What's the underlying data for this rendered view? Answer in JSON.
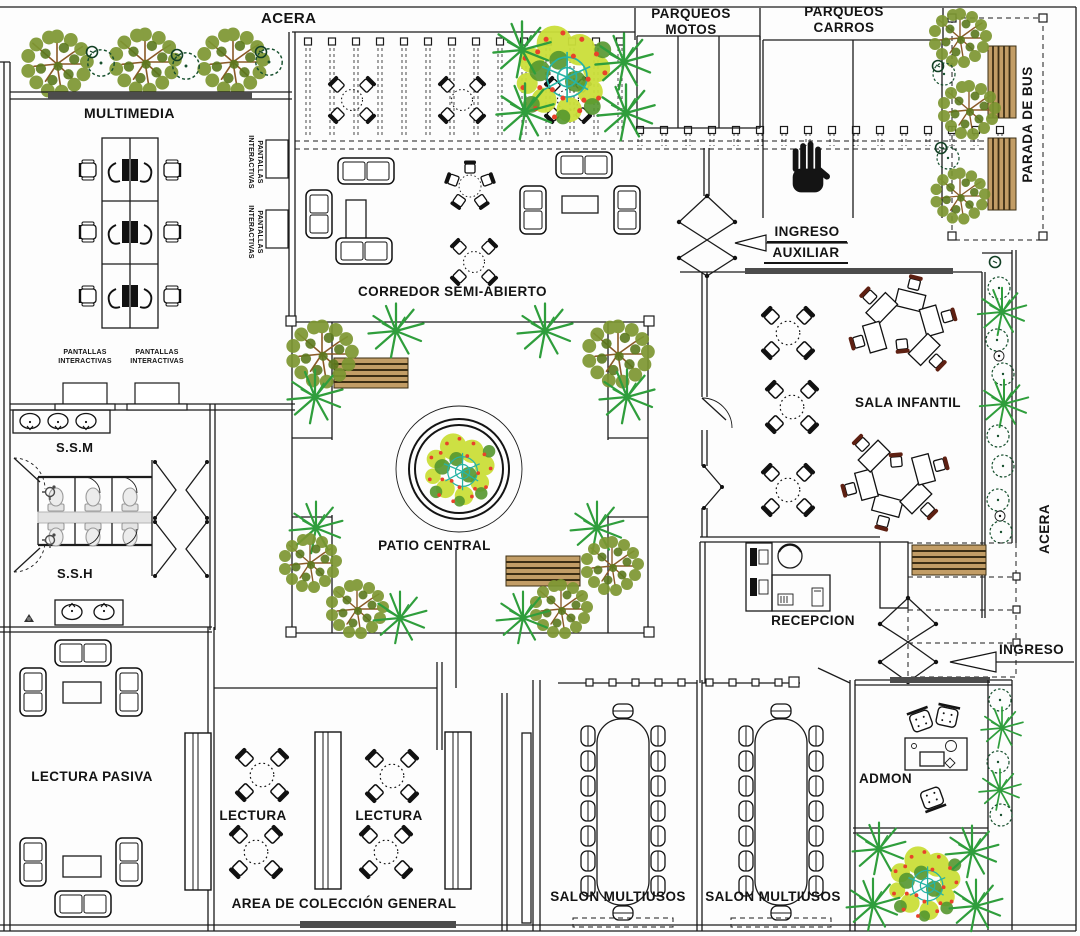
{
  "labels": {
    "acera_top": "ACERA",
    "parqueos_motos_1": "PARQUEOS",
    "parqueos_motos_2": "MOTOS",
    "parqueos_carros_1": "PARQUEOS",
    "parqueos_carros_2": "CARROS",
    "parada_bus": "PARADA DE BUS",
    "multimedia": "MULTIMEDIA",
    "pantallas_1": "PANTALLAS",
    "pantallas_2": "INTERACTIVAS",
    "corredor": "CORREDOR SEMI-ABIERTO",
    "ingreso_auxiliar_1": "INGRESO",
    "ingreso_auxiliar_2": "AUXILIAR",
    "sala_infantil": "SALA INFANTIL",
    "ssm": "S.S.M",
    "ssh": "S.S.H",
    "patio_central": "PATIO CENTRAL",
    "acera_right": "ACERA",
    "recepcion": "RECEPCION",
    "ingreso": "INGRESO",
    "lectura_pasiva": "LECTURA PASIVA",
    "lectura": "LECTURA",
    "area_coleccion": "AREA DE COLECCIÓN GENERAL",
    "salon_multiusos": "SALON MULTIUSOS",
    "admon": "ADMON"
  },
  "colors": {
    "line": "#1c1c1c",
    "wall_accent": "#4c4c4c",
    "foliage": "#7d9732",
    "foliage_dark": "#5c7a1f",
    "branch": "#8a5a28",
    "palm_green": "#2f9e3c",
    "bush_green": "#17502e",
    "bench_wood": "#c29d66",
    "flower_red": "#e8432a",
    "flower_yellow": "#cbdf3a",
    "teal": "#27b3a4",
    "fixture_gray": "#e3e3e3"
  }
}
